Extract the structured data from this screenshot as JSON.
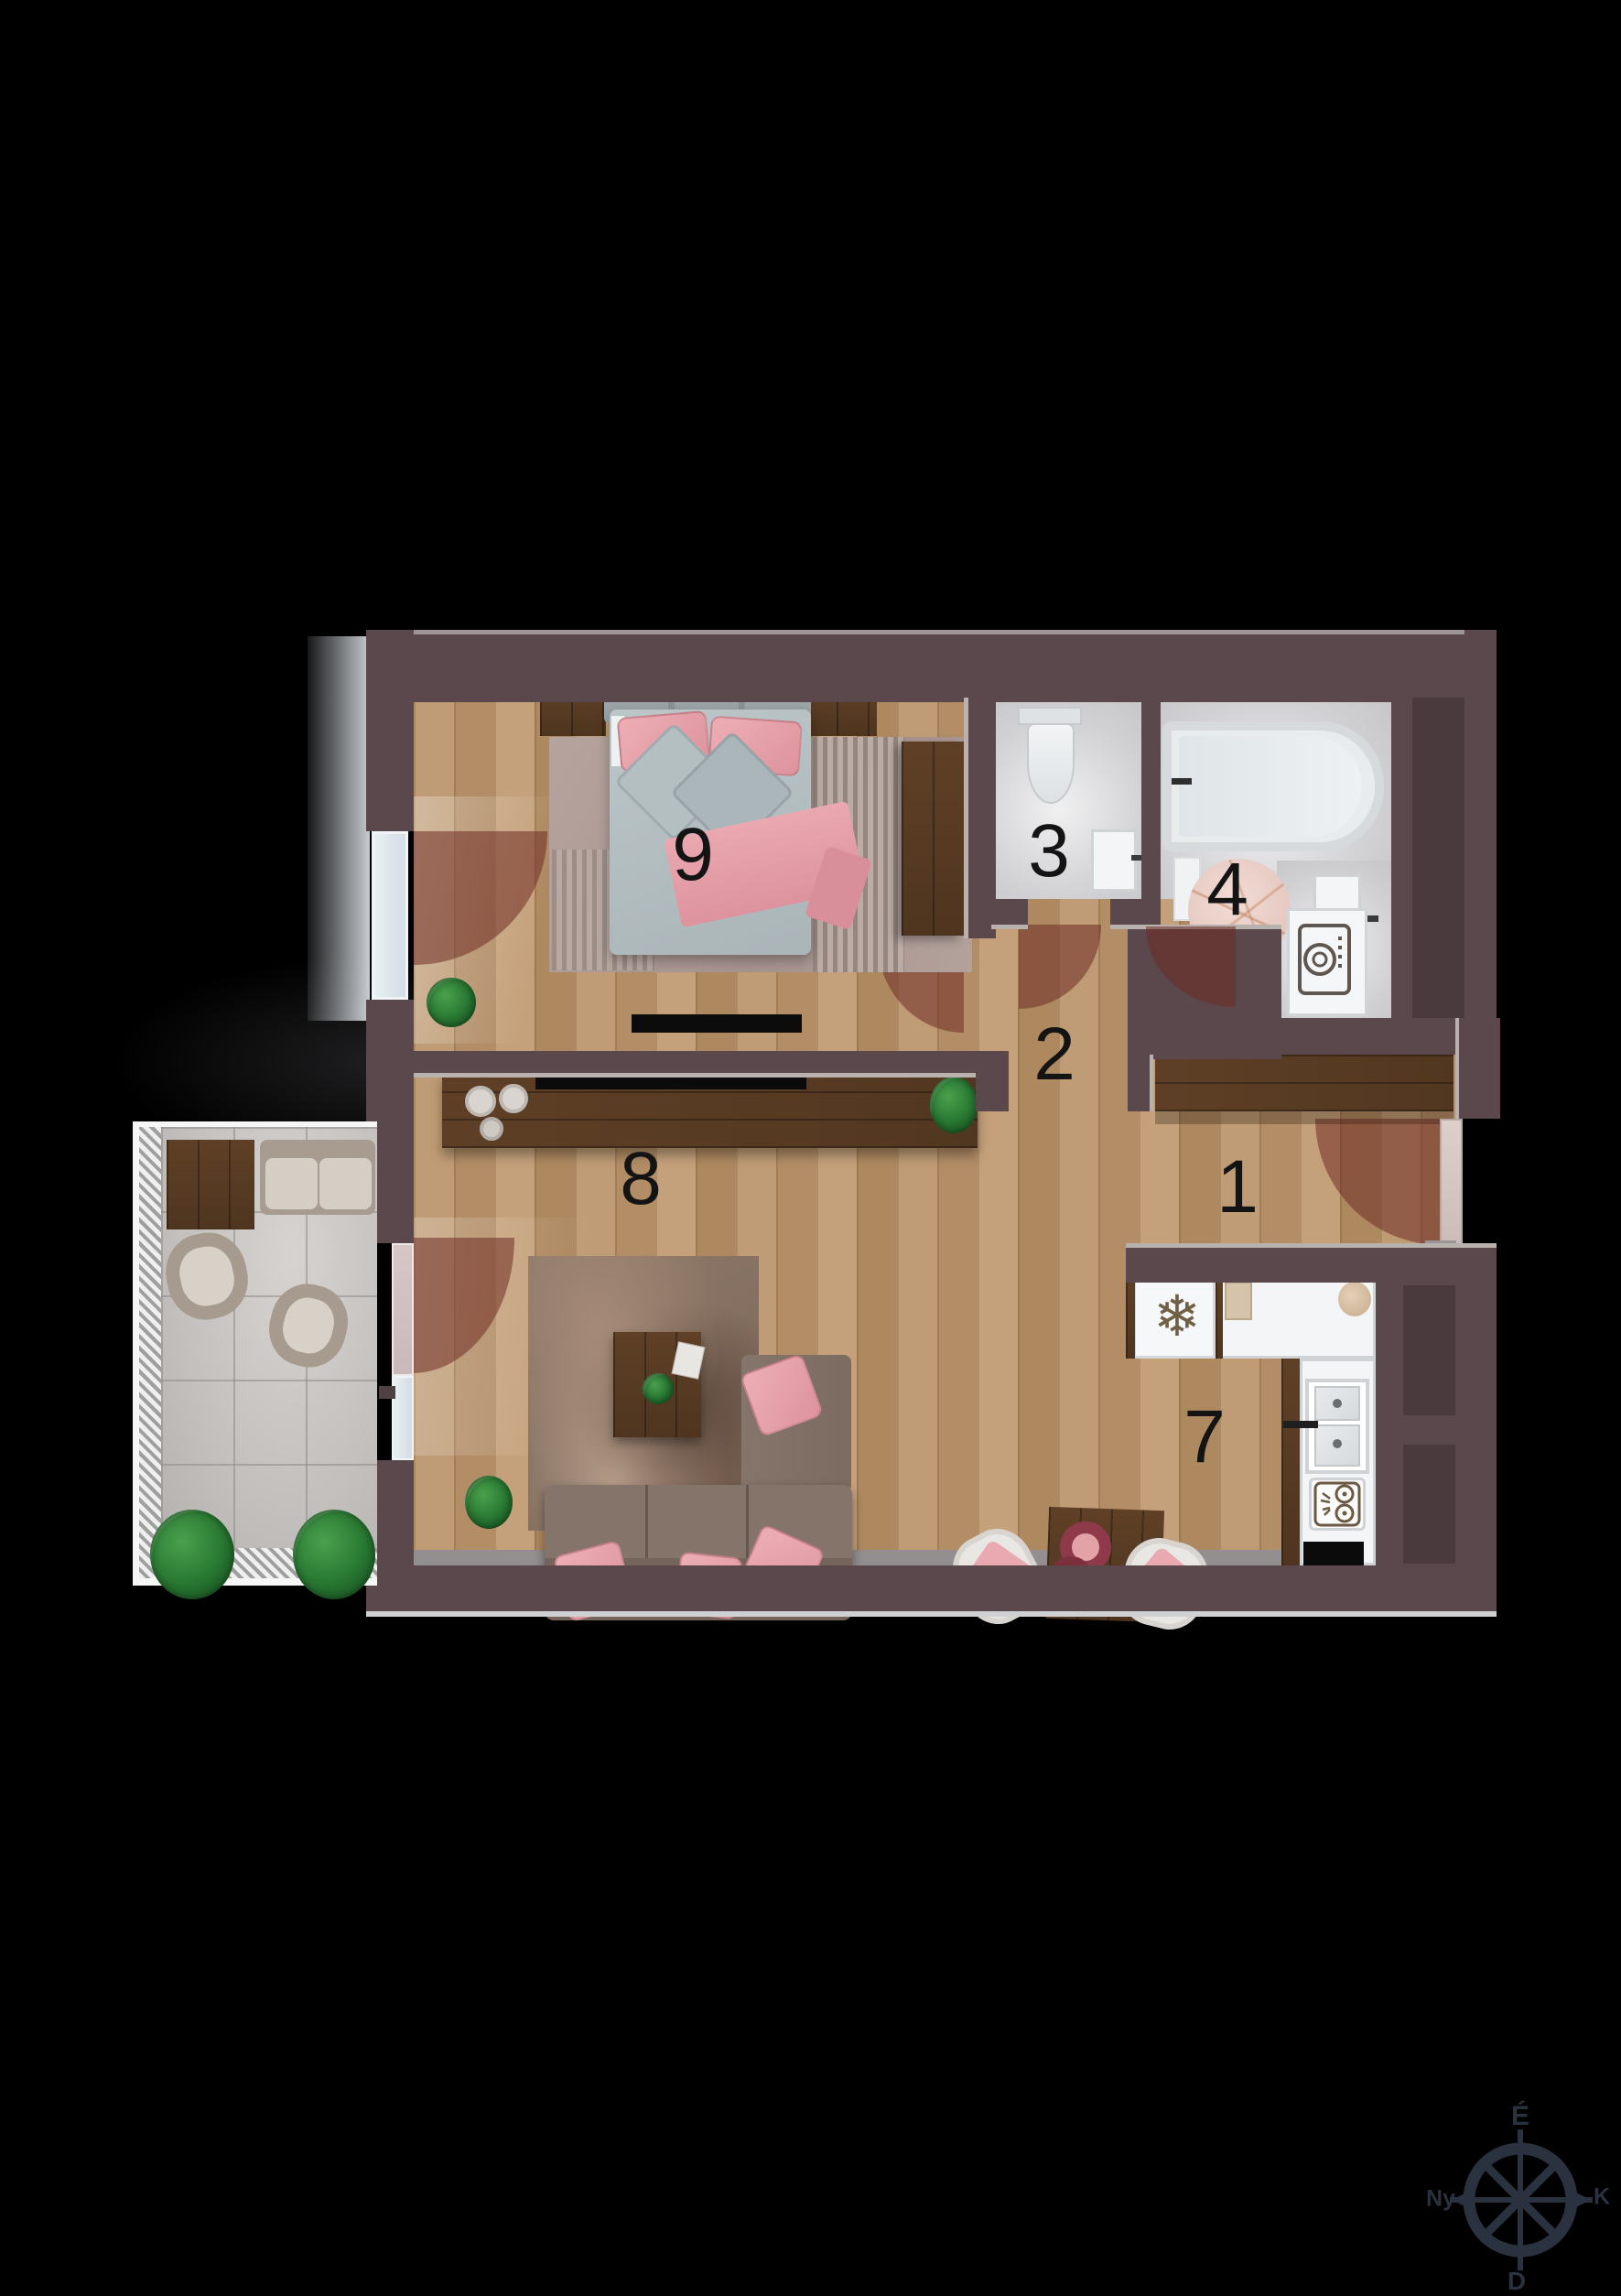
{
  "plan": {
    "type": "apartment-floor-plan-3d-top-view",
    "rooms": [
      {
        "number": "1",
        "name": "entrance-hall"
      },
      {
        "number": "2",
        "name": "hallway"
      },
      {
        "number": "3",
        "name": "toilet"
      },
      {
        "number": "4",
        "name": "bathroom"
      },
      {
        "number": "7",
        "name": "kitchen"
      },
      {
        "number": "8",
        "name": "living-room"
      },
      {
        "number": "9",
        "name": "bedroom"
      }
    ],
    "compass": {
      "north": "É",
      "south": "D",
      "east": "K",
      "west": "Ny"
    },
    "colors": {
      "background": "#000000",
      "wall": "#5a484c",
      "wall_recess": "#4a393d",
      "wood_floor": "#b8936b",
      "dark_wood": "#573a23",
      "bath_tile": "#d6d6d8",
      "balcony_tile": "#c8c5c3",
      "accent_pink": "#e5a0a9",
      "duvet_gray": "#b6c0c3",
      "door_swing_arc": "rgba(112,44,36,0.55)",
      "compass": "#2a3240",
      "label_text": "#141414"
    },
    "icons": [
      "snowflake-icon",
      "washer-drum-icon",
      "stove-burners-icon",
      "compass-rose-icon"
    ]
  }
}
